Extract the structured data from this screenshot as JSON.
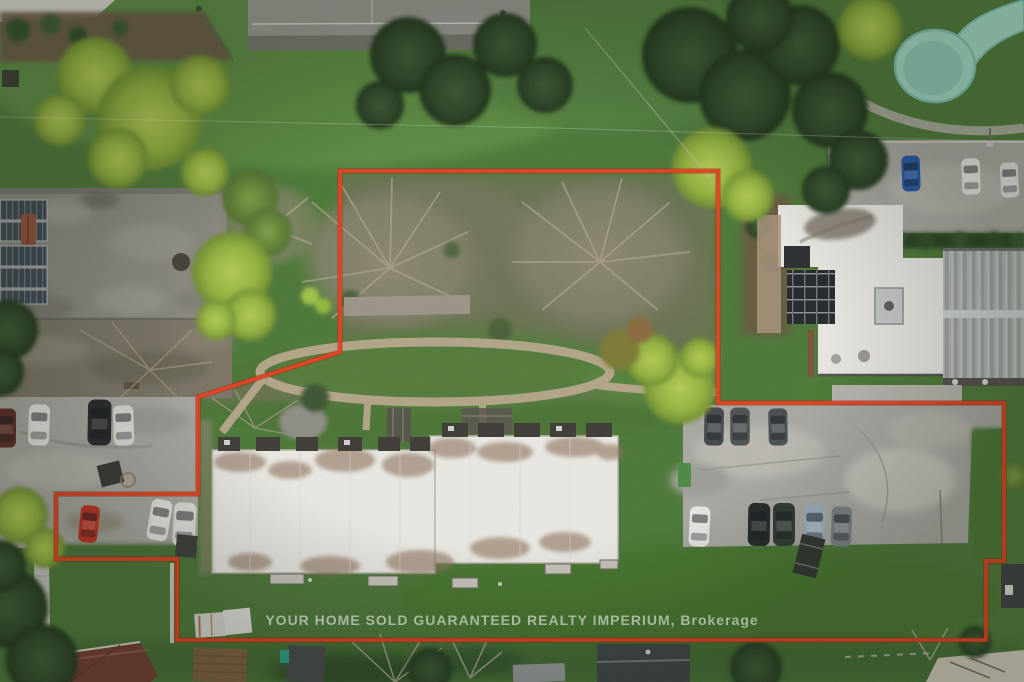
{
  "watermark": {
    "text": "YOUR HOME SOLD GUARANTEED REALTY IMPERIUM, Brokerage"
  },
  "colors": {
    "boundary_red": "#e8401f",
    "boundary_red_dark": "#9c2410",
    "grass_green": "#4d7839",
    "scrub_olive": "#6b7252",
    "asphalt_gray": "#a9a8a2",
    "concrete_light": "#b7b5ae",
    "roof_white": "#eae8e3",
    "roof_stain_brown": "#8a7058",
    "left_roof_gray": "#8c8a82",
    "solar_panel_blue": "#3e4852",
    "waterslide_mint": "#a3d8c5",
    "conifer_green": "#2c4527",
    "bright_foliage": "#9dbe48",
    "dirt_path_tan": "#b7a78c",
    "watermark_text": "#cdd6c9"
  }
}
